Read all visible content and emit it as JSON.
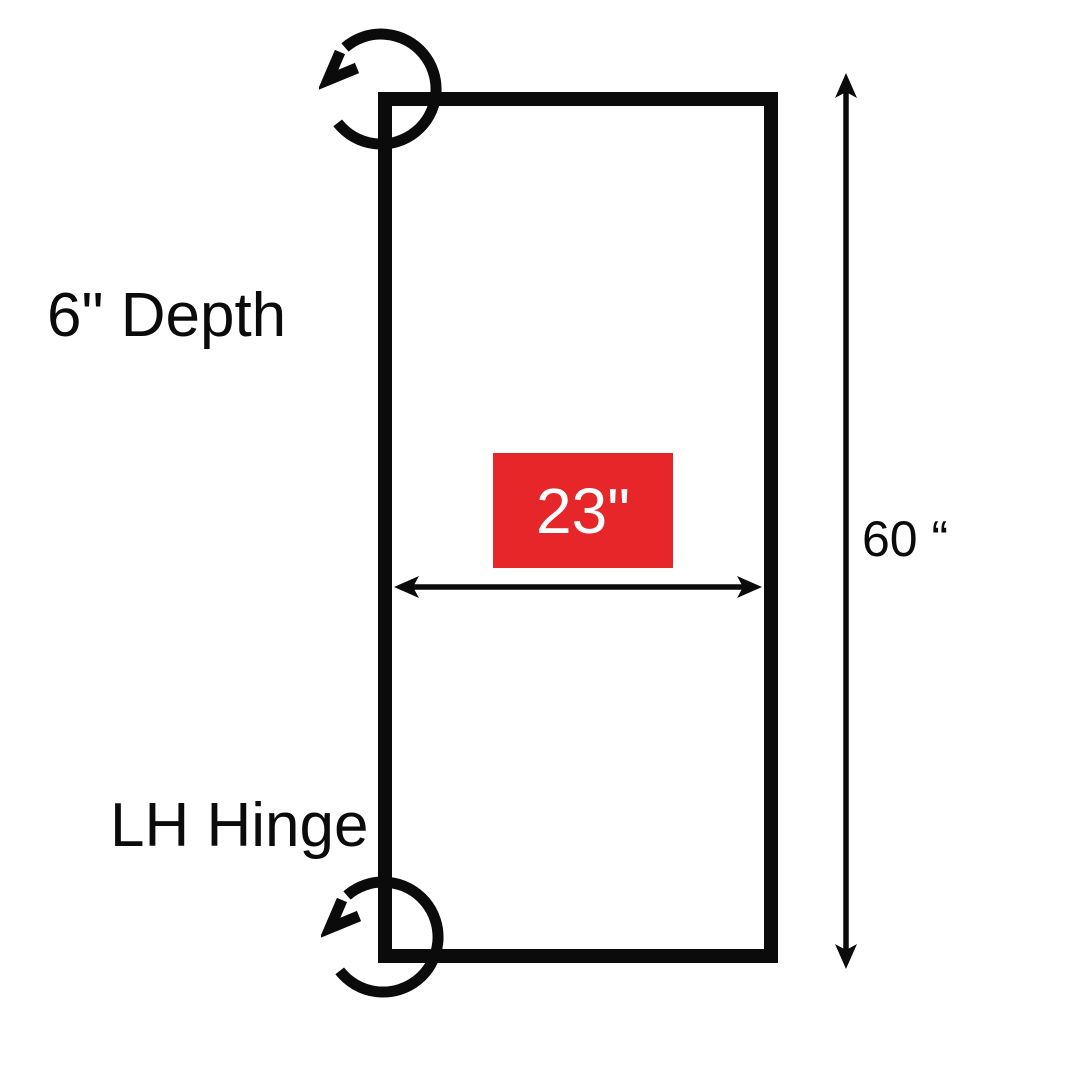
{
  "labels": {
    "depth": "6\" Depth",
    "hinge": "LH Hinge",
    "width": "23\"",
    "height": "60 “"
  },
  "colors": {
    "line": "#0B0B0B",
    "accent_red": "#E62629",
    "badge_text": "#FFFFFF",
    "background": "#FFFFFF"
  },
  "icons": {
    "top_left_corner": "rotate-counterclockwise-icon",
    "bottom_left_corner": "rotate-counterclockwise-icon"
  }
}
